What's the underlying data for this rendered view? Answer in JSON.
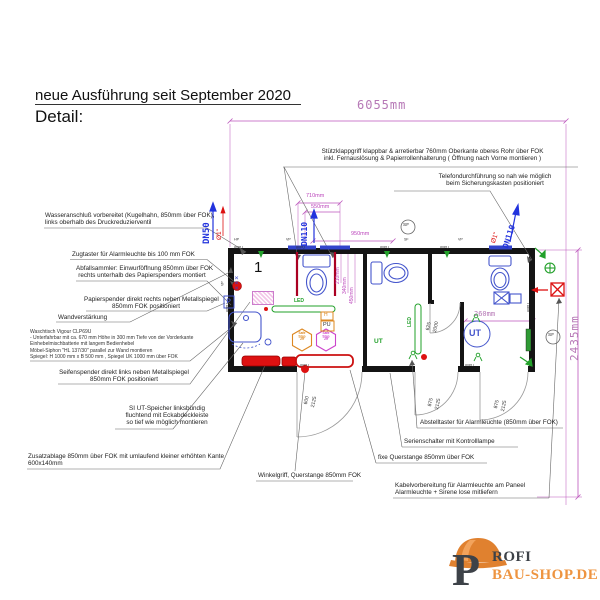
{
  "title": {
    "heading": "neue Ausführung seit September 2020",
    "subheading": "Detail:"
  },
  "annotations": {
    "stuetzklappgriff": {
      "line1": "Stützklappgriff klappbar & arretierbar  760mm Oberkante oberes Rohr  über FOK",
      "line2": "inkl. Fernauslösung  & Papierrollenhalterung ( Öffnung nach Vorne montieren )"
    },
    "telefon": {
      "line1": "Telefondurchführung so nah wie möglich",
      "line2": "beim Sicherungskasten positioniert"
    },
    "wasseranschluss": {
      "line1": "Wasseranschluß vorbereitet (Kugelhahn, 850mm über FOK),",
      "line2": "links oberhalb des Druckreduzierventil"
    },
    "zugtaster": {
      "text": "Zugtaster für Alarmleuchte bis 100 mm FOK"
    },
    "abfallsammler": {
      "line1": "Abfallsammler: Einwurföffnung 850mm über FOK",
      "line2": "rechts unterhalb des Papierspenders montiert"
    },
    "papierspender": {
      "line1": "Papierspender direkt rechts neben Metallspiegel",
      "line2": "850mm FOK positioniert"
    },
    "wandverstaerkung": {
      "text": "Wandverstärkung"
    },
    "waschtisch": {
      "line1": "Waschtisch Vigour CLP69U",
      "line2": "- Unterfahrbar mit ca. 670 mm Höhe in 300 mm Tiefe von der Vorderkante",
      "line3": "Einhebelmischbatterie mit langem Bedienhebel",
      "line4": "Möbel-Siphon \"HL 137/30\" parallel zur Wand montieren",
      "line5": "Spiegel: H 1000 mm x B 500 mm ,  Spiegel UK  1000 mm über FOK"
    },
    "seifenspender": {
      "line1": "Seifenspender direkt links neben Metallspiegel",
      "line2": "850mm FOK positioniert"
    },
    "ut_speicher": {
      "line1": "SI UT-Speicher linksbündig",
      "line2": "fluchtend mit Eckabdeckleiste",
      "line3": "so tief wie möglich montieren"
    },
    "zusatzablage": {
      "line1": "Zusatzablage 850mm über FOK mit umlaufend kleiner erhöhten Kante",
      "line2": "600x140mm"
    },
    "winkelgriff": {
      "text": "Winkelgriff, Querstange 850mm FOK"
    },
    "abstelltaster": {
      "text": "Abstelltaster für Alarmleuchte (850mm über FOK)"
    },
    "serienschalter": {
      "text": "Serienschalter mit Kontrolllampe"
    },
    "fixe_querstange": {
      "text": "fixe Querstange 850mm über FOK"
    },
    "kabelvorbereitung": {
      "line1": "Kabelvorbereitung für Alarmleuchte am Paneel",
      "line2": "Alarmleuchte + Sirene lose mitliefern"
    }
  },
  "dimensions": {
    "total_width": "6055mm",
    "total_depth": "2435mm",
    "w710": "710mm",
    "w550": "550mm",
    "w950": "950mm",
    "v210": "210mm",
    "v340": "340mm",
    "v450": "450mm",
    "w260": "260mm",
    "door_main_w": "600",
    "door_main_h": "2125",
    "door_wc_w": "875",
    "door_wc_h": "2125",
    "door_int_w": "625",
    "door_int_h": "2000"
  },
  "plan": {
    "room_number": "1",
    "pipe_dn50": "DN50",
    "pipe_dn110": "DN110",
    "pipe_diameter": "Ø1\"",
    "label_hp": "HP",
    "label_vp": "VP",
    "label_sf": "SF",
    "panel": "80PU",
    "led": "LED",
    "box_h": "H",
    "box_pu": "PU",
    "box_p": "P",
    "ut": "UT",
    "safestep_l1": "Safe",
    "safestep_l2": "Step",
    "safestep_num": "29",
    "marks": "×××"
  },
  "logo": {
    "initial": "P",
    "name_rest": "ROFI",
    "domain": "BAU-SHOP.DE"
  },
  "colors": {
    "dimension_magenta": "#bb44bb",
    "fixture_blue": "#4455cc",
    "pipe_blue": "#2233dd",
    "alarm_red": "#dd1111",
    "rail_red": "#aa0022",
    "accent_green": "#22a02a",
    "accent_orange": "#dd8822",
    "wall_black": "#141414",
    "logo_orange": "#ee9440",
    "logo_dark": "#3d4248"
  }
}
